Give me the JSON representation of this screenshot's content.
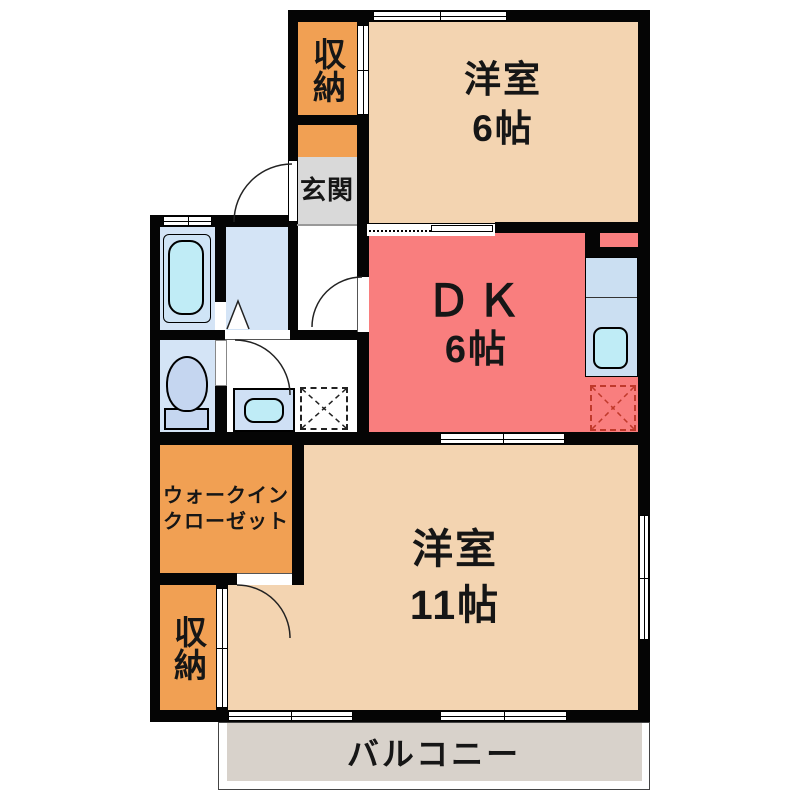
{
  "plan": {
    "type": "apartment-floor-plan",
    "rooms": {
      "storage_top": {
        "label": "収納"
      },
      "western6": {
        "name": "洋室",
        "size": "6帖"
      },
      "entrance": {
        "label": "玄関"
      },
      "dk": {
        "name": "ＤＫ",
        "size": "6帖"
      },
      "wic": {
        "line1": "ウォークイン",
        "line2": "クローゼット"
      },
      "storage_bottom": {
        "label": "収納"
      },
      "western11": {
        "name": "洋室",
        "size": "11帖"
      },
      "balcony": {
        "label": "バルコニー"
      }
    },
    "fixtures": [
      "bathtub",
      "toilet",
      "washbasin",
      "washing-machine-space",
      "kitchen-counter",
      "kitchen-sink",
      "refrigerator-space"
    ],
    "colors": {
      "wall": "#050505",
      "western_room": "#f3d4b1",
      "dining_kitchen": "#f97e7e",
      "storage_orange": "#f1a053",
      "entrance_gray": "#d9d9d9",
      "balcony_gray": "#d8d2cb",
      "wet_area_blue": "#d4e4f6",
      "fixture_cyan": "#c0ecf6",
      "refrigerator_dash_red": "#c0392b"
    }
  }
}
